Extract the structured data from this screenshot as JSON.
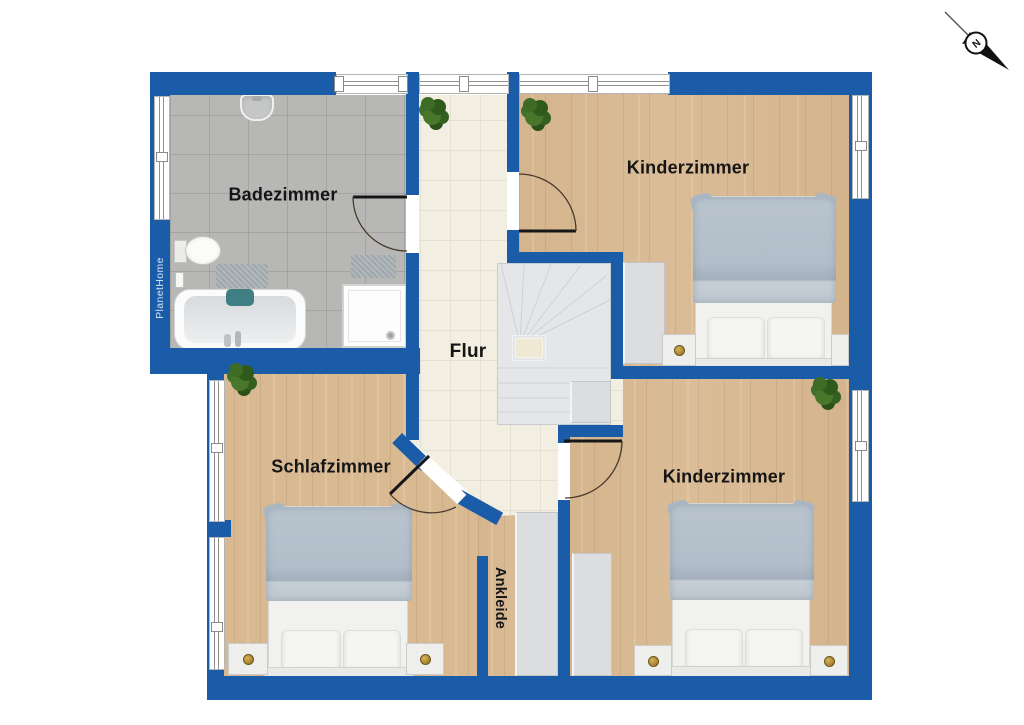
{
  "plan": {
    "type": "floor-plan",
    "floor_texts": {
      "bathroom": "Badezimmer",
      "child_room_top": "Kinderzimmer",
      "hallway": "Flur",
      "bedroom": "Schlafzimmer",
      "child_room_bottom": "Kinderzimmer",
      "dressing": "Ankleide"
    }
  },
  "rooms": [
    {
      "id": "badezimmer",
      "label": "Badezimmer",
      "floor": "gray-tile"
    },
    {
      "id": "kinderzimmer-top",
      "label": "Kinderzimmer",
      "floor": "wood"
    },
    {
      "id": "flur",
      "label": "Flur",
      "floor": "cream-tile"
    },
    {
      "id": "schlafzimmer",
      "label": "Schlafzimmer",
      "floor": "wood"
    },
    {
      "id": "kinderzimmer-bottom",
      "label": "Kinderzimmer",
      "floor": "wood"
    },
    {
      "id": "ankleide",
      "label": "Ankleide",
      "floor": "wood"
    }
  ],
  "branding": {
    "logo_text": "PlanetHome"
  },
  "compass": {
    "north_label": "N",
    "direction": "north-west"
  },
  "fixtures": [
    "bathtub",
    "shower",
    "toilet",
    "sink",
    "bath-mat",
    "double-bed",
    "nightstand",
    "wardrobe",
    "staircase",
    "plant",
    "door",
    "window"
  ],
  "palette": {
    "wall_blue": "#1b5ca9",
    "wood_floor": "#d8b992",
    "bath_tile": "#b7b7b5",
    "hall_tile": "#f2eee2",
    "stair_gray": "#e4e6e8",
    "blanket_gray_blue": "#b2bec9",
    "plant_green": "#3e6b25",
    "tub_pillow_teal": "#3f7e82",
    "knob_gold": "#9c7a2e",
    "label_black": "#151515"
  }
}
